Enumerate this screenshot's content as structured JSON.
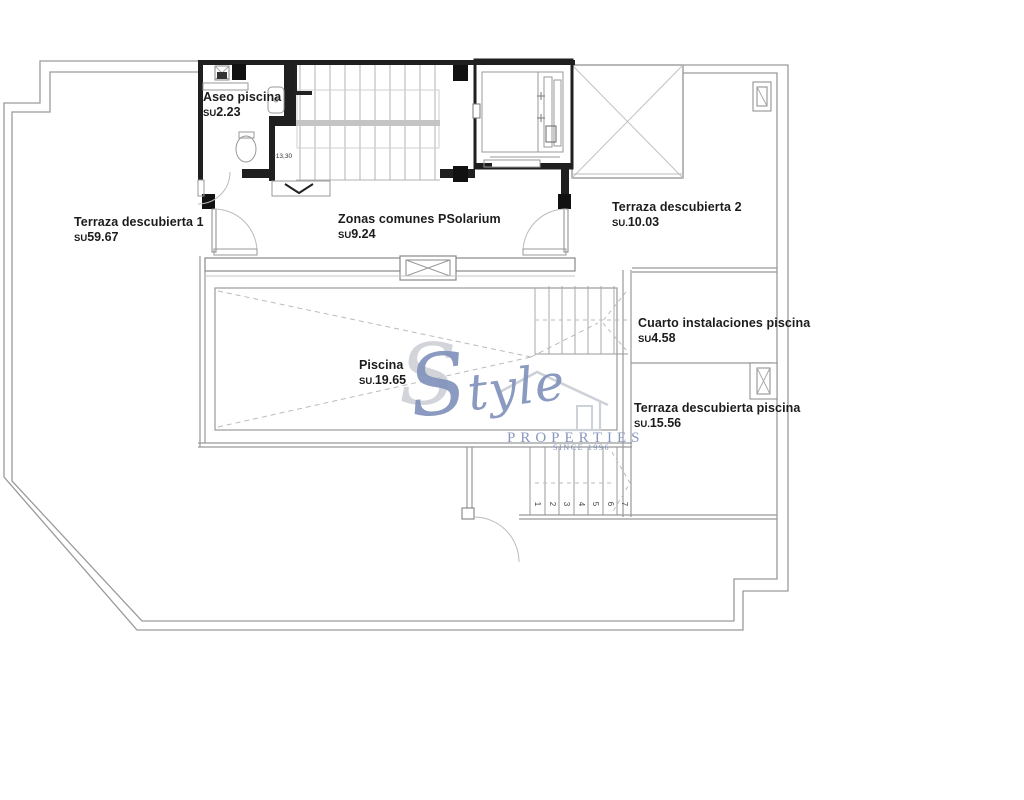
{
  "rooms": [
    {
      "name": "Aseo piscina",
      "su": "SU",
      "value": "2.23"
    },
    {
      "name": "Terraza descubierta 1",
      "su": "SU",
      "value": "59.67"
    },
    {
      "name": "Zonas comunes PSolarium",
      "su": "SU",
      "value": "9.24"
    },
    {
      "name": "Terraza descubierta 2",
      "su": "SU.",
      "value": "10.03"
    },
    {
      "name": "Piscina",
      "su": "SU.",
      "value": "19.65"
    },
    {
      "name": "Cuarto instalaciones piscina",
      "su": "SU",
      "value": "4.58"
    },
    {
      "name": "Terraza descubierta piscina",
      "su": "SU.",
      "value": "15.56"
    }
  ],
  "level_mark": "+13,30",
  "stairs": {
    "steps": [
      "1",
      "2",
      "3",
      "4",
      "5",
      "6",
      "7"
    ]
  },
  "watermark": {
    "monogram": "S",
    "brand_cap": "S",
    "brand_rest": "tyle",
    "word": "PROPERTIES",
    "tagline": "SINCE 1996",
    "brand_color": "#8292bb"
  },
  "colors": {
    "wall_dark": "#1f1f1f",
    "line": "#999999",
    "line_light": "#bbbbbb",
    "text": "#1c1c1c"
  }
}
